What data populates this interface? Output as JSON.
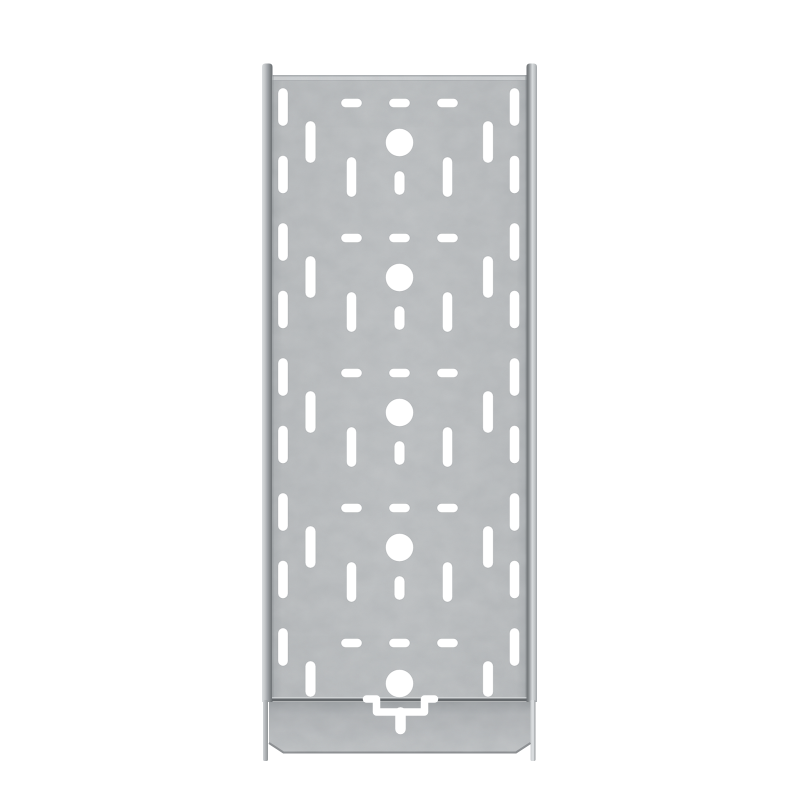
{
  "scene": {
    "type": "product-photo",
    "subject": "perforated galvanized steel cable tray, straight section, viewed from above on white background",
    "background": "#ffffff",
    "has_text": false
  },
  "palette": {
    "background": "#ffffff",
    "panel_base": "#b9bcbe",
    "panel_edge_dark": "#8d9194",
    "top_fold_light": "#ced1d3",
    "rail_dark": "#6b6f72",
    "rail_light": "#d9dcde",
    "overlap_shadow_line": "#63676a",
    "overlap_highlight_line": "#d8dbdd",
    "coupler_top": "#a0a4a7",
    "coupler_bottom": "#bec1c3",
    "coupler_edge": "#7e8285",
    "hole_color": "#ffffff"
  },
  "geometry": {
    "canvas": {
      "w": 800,
      "h": 800
    },
    "panel": {
      "x": 272,
      "y": 75,
      "w": 254.5,
      "h": 624
    },
    "left_rail": {
      "x": 262,
      "w": 10.5,
      "top": 63.5,
      "bottom": 702
    },
    "right_rail": {
      "x": 526.5,
      "w": 10.5,
      "top": 63.5,
      "bottom": 702
    },
    "rail_tails": {
      "left_x": 263,
      "right_x": 530.5,
      "w": 5,
      "y": 700,
      "h": 61
    },
    "coupler": {
      "x": 269,
      "top": 702,
      "w": 261.5,
      "bottom": 752.5,
      "chamfer": 14.5
    }
  },
  "perforations": {
    "period": 135,
    "center_x": 399.5,
    "panel_bottom_limit": 697,
    "circles": {
      "r": 14,
      "cy_list": [
        142.5,
        277.5,
        412.5,
        547.5,
        683.5
      ]
    },
    "top_slot_rows": {
      "cx_list": [
        351.5,
        399.5,
        447.5
      ],
      "cy_start": 103,
      "count": 5,
      "w": 21,
      "h": 9
    },
    "center_slots": {
      "cx": 399.5,
      "cy_start": 183,
      "count": 4,
      "w": 10.5,
      "h": 24
    },
    "inner_columns": {
      "cx_list": [
        351.5,
        447.5
      ],
      "y_start": 157,
      "count": 4,
      "w": 10,
      "h": 40
    },
    "middle_columns": {
      "cx_list": [
        310.5,
        488
      ],
      "y_start": 121,
      "count": 5,
      "w": 10.5,
      "h": 42
    },
    "outer_columns": {
      "cx_list": [
        283,
        514.5
      ],
      "y_start": 88,
      "step": 67.5,
      "count": 9,
      "w": 10,
      "h": 38
    }
  },
  "coupler_cutout": {
    "u_path": "M366.5,699 H376.5 V712 H424.5 V699 H434.5",
    "u_stroke_w": 7.5,
    "stem_path": "M400.5,712.5 V729",
    "stem_stroke_w": 10.5
  }
}
